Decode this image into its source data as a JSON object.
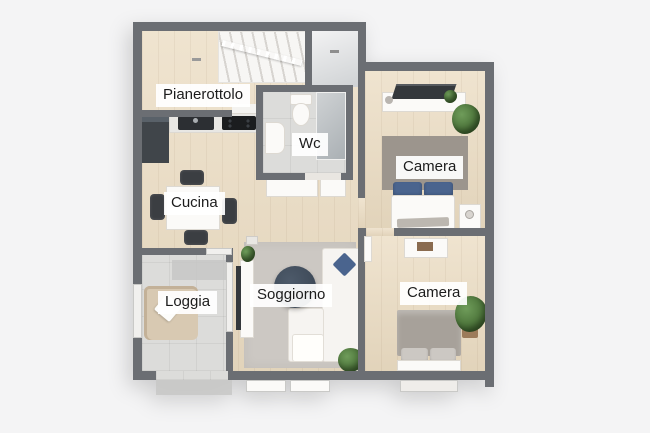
{
  "title": "3D floor plan (pianta 3D appartamento)",
  "rooms": {
    "pianerottolo": {
      "label": "Pianerottolo"
    },
    "wc": {
      "label": "Wc"
    },
    "camera_top": {
      "label": "Camera"
    },
    "cucina": {
      "label": "Cucina"
    },
    "soggiorno": {
      "label": "Soggiorno"
    },
    "loggia": {
      "label": "Loggia"
    },
    "camera_bottom": {
      "label": "Camera"
    }
  },
  "colors": {
    "background": "#f4f4f5",
    "wall": "#6b6e73",
    "wood_floor": "#ebdcc2",
    "tile_floor": "#dcdcda",
    "rug_gray": "#ccc8c3",
    "rug_warm": "#9c958d",
    "bed_blanket": "#a7a19a",
    "pillow_blue": "#4a648e",
    "furniture_dark": "#34383c",
    "chair_dark": "#3b3e42",
    "plant_green": "#40662f",
    "armchair_beige": "#d8c9b2",
    "coffee_table": "#3e4a58",
    "label_text": "#1c1c1c"
  }
}
